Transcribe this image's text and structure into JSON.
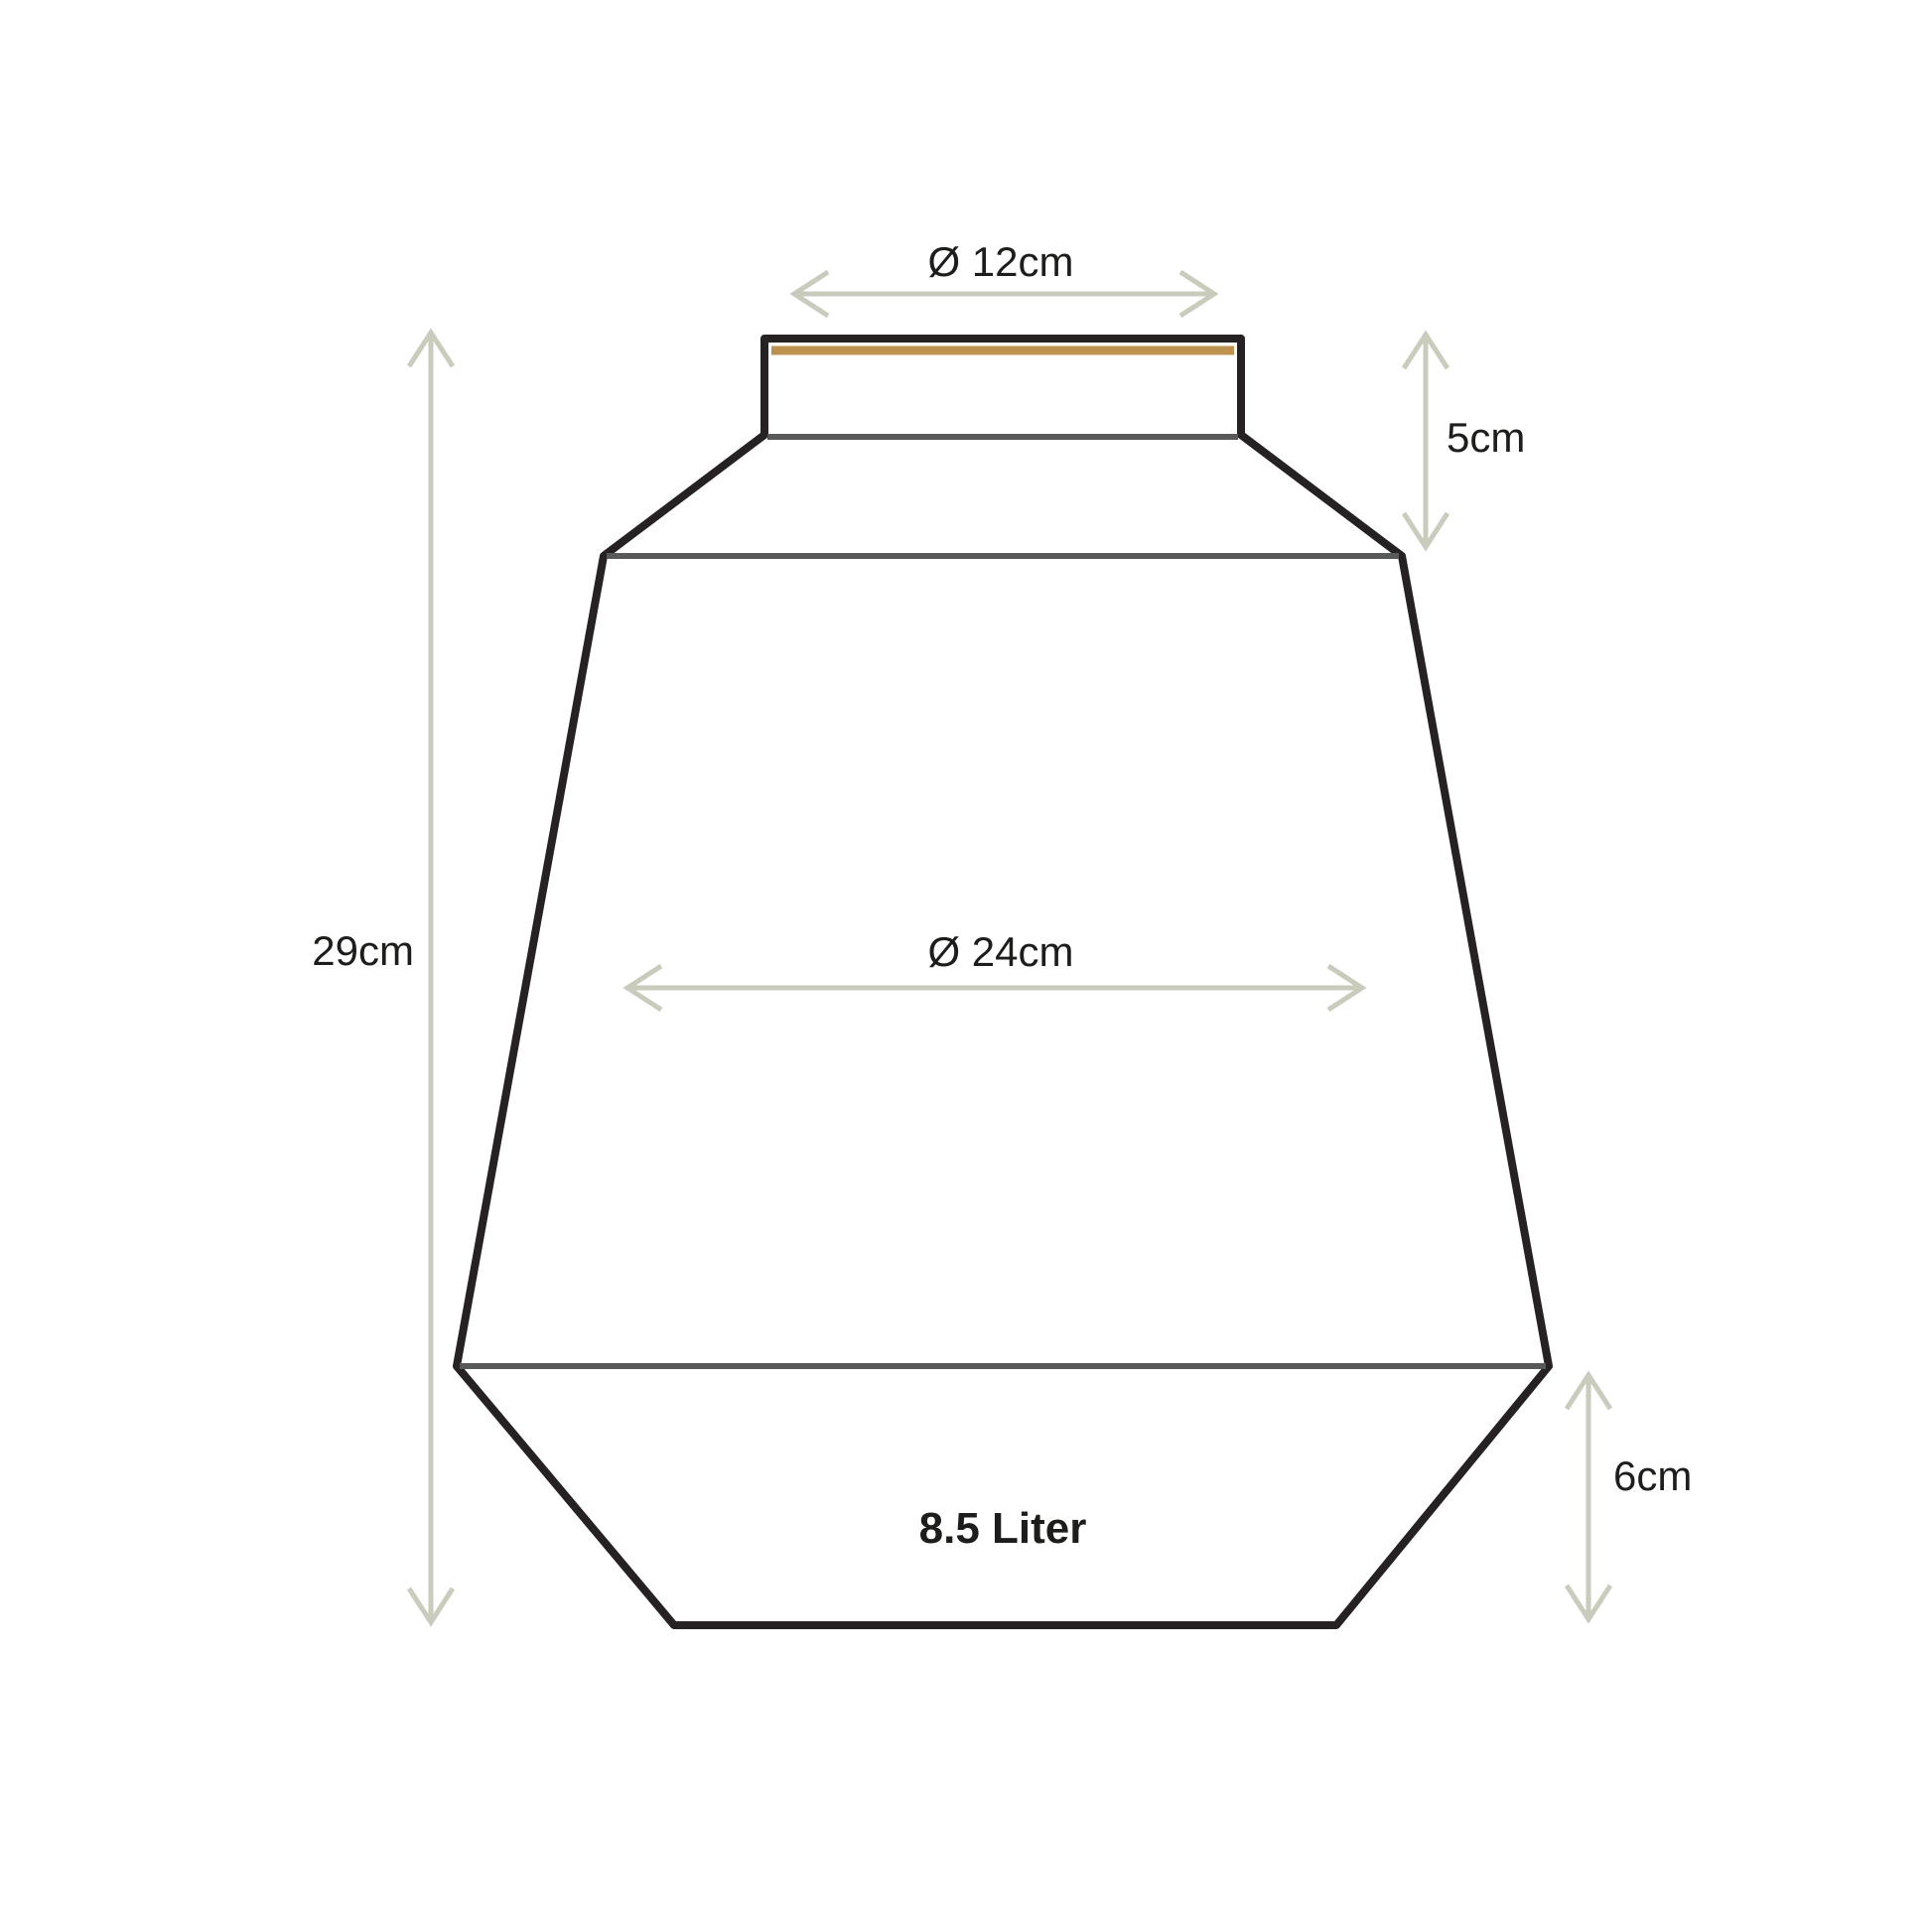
{
  "diagram": {
    "dimensions": {
      "top_diameter": "Ø 12cm",
      "neck_height": "5cm",
      "total_height": "29cm",
      "body_diameter": "Ø 24cm",
      "base_height": "6cm",
      "capacity": "8.5 Liter"
    },
    "colors": {
      "outline": "#262223",
      "inner_line": "#58595b",
      "rim_accent": "#bd9150",
      "dimension_arrow": "#c9cbbc",
      "text": "#1d1d1b",
      "background": "#ffffff"
    }
  }
}
